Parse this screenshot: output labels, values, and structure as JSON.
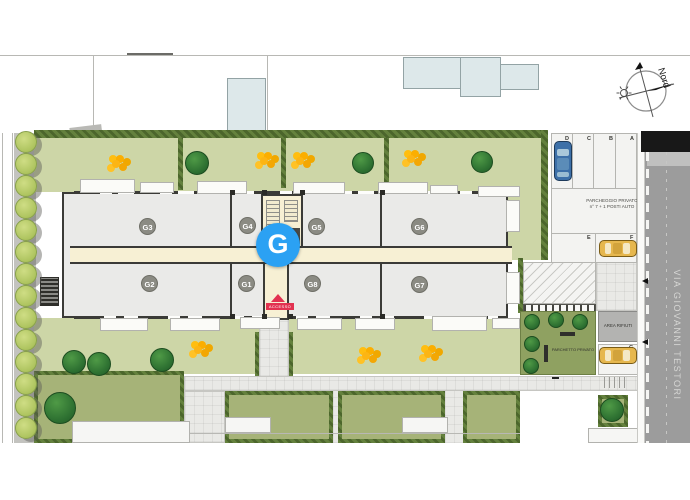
{
  "compass": {
    "label": "Nord"
  },
  "street": {
    "name": "VIA GIOVANNI TESTORI"
  },
  "building": {
    "marker_label": "G",
    "units": [
      "G3",
      "G4",
      "G5",
      "G6",
      "G2",
      "G1",
      "G8",
      "G7"
    ],
    "entrance_label": "ACCESSO"
  },
  "parking": {
    "line1": "PARCHEGGIO PRIVATO",
    "line2": "n° 7 + 1 POSTI AUTO",
    "top_spots": [
      "D",
      "C",
      "B",
      "A"
    ],
    "mid_spots": [
      "E",
      "F"
    ],
    "side_spot": "G"
  },
  "areas": {
    "waste": "AREA RIFIUTI",
    "park": "PARCHETTO PRIVATO"
  },
  "colors": {
    "marker_blue": "#2ba1f3",
    "lawn_green": "#cdd6a7",
    "garden_green": "#a6b378",
    "hedge_green": "#56732f",
    "road_gray": "#9c9c9c",
    "entrance_red": "#e23250",
    "flower_yellow": "#fcb514",
    "car_blue": "#3d70a8",
    "car_yellow": "#e6b74e"
  }
}
